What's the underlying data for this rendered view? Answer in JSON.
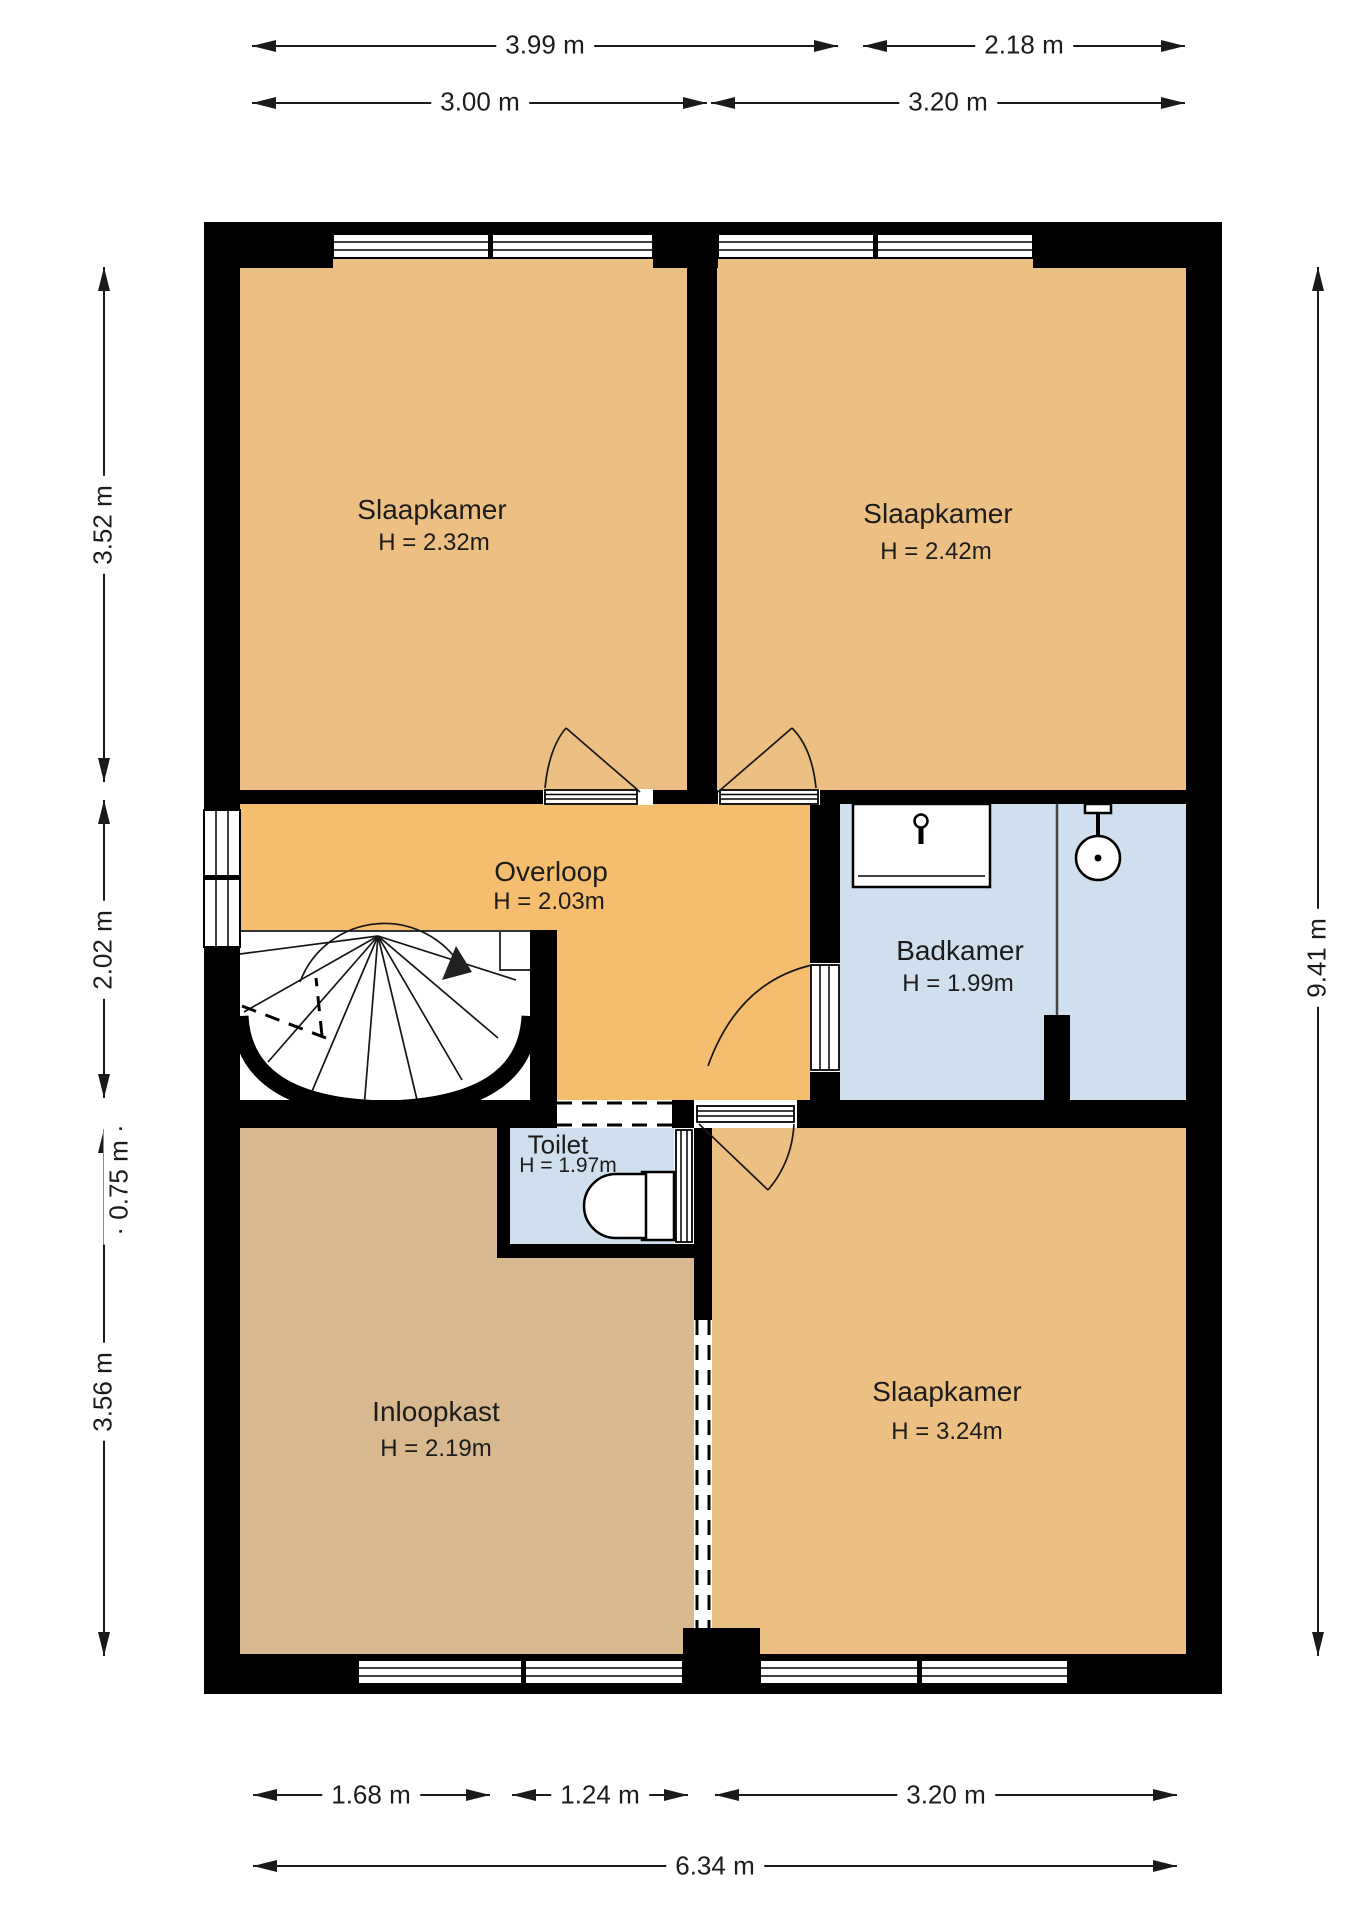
{
  "plan": {
    "rooms": [
      {
        "id": "slaapkamer-1",
        "name": "Slaapkamer",
        "height_label": "H = 2.32m"
      },
      {
        "id": "slaapkamer-2",
        "name": "Slaapkamer",
        "height_label": "H = 2.42m"
      },
      {
        "id": "overloop",
        "name": "Overloop",
        "height_label": "H = 2.03m"
      },
      {
        "id": "badkamer",
        "name": "Badkamer",
        "height_label": "H = 1.99m"
      },
      {
        "id": "toilet",
        "name": "Toilet",
        "height_label": "H = 1.97m"
      },
      {
        "id": "inloopkast",
        "name": "Inloopkast",
        "height_label": "H = 2.19m"
      },
      {
        "id": "slaapkamer-3",
        "name": "Slaapkamer",
        "height_label": "H = 3.24m"
      }
    ],
    "features": {
      "staircase": "spiral-staircase",
      "fixtures": [
        "sink",
        "shower-head",
        "toilet-bowl"
      ],
      "window_count": 5,
      "door_count": 5
    }
  },
  "dimensions": {
    "top_row_1": [
      {
        "label": "3.99 m"
      },
      {
        "label": "2.18 m"
      }
    ],
    "top_row_2": [
      {
        "label": "3.00 m"
      },
      {
        "label": "3.20 m"
      }
    ],
    "left": [
      {
        "label": "3.52 m"
      },
      {
        "label": "2.02 m"
      },
      {
        "label": "· 0.75 m ·"
      },
      {
        "label": "3.56 m"
      }
    ],
    "right": [
      {
        "label": "9.41 m"
      }
    ],
    "bottom_row_1": [
      {
        "label": "1.68 m"
      },
      {
        "label": "1.24 m"
      },
      {
        "label": "3.20 m"
      }
    ],
    "bottom_row_2": [
      {
        "label": "6.34 m"
      }
    ]
  },
  "colors": {
    "wall": "#000000",
    "room_orange": "#ecc083",
    "room_hall": "#f5bd6e",
    "room_closet": "#d8b88e",
    "room_wet": "#cfdfee",
    "line": "#1a1a1a",
    "background": "#ffffff"
  }
}
